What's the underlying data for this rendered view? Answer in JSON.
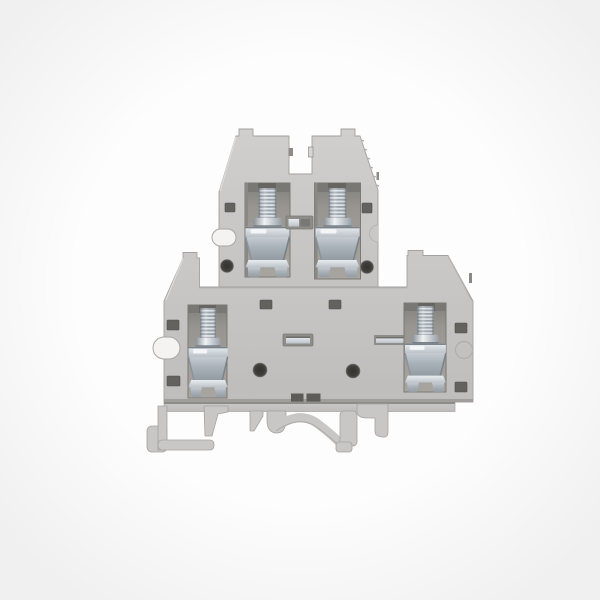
{
  "meta": {
    "description": "Product photograph of a gray double-level DIN-rail screw terminal block centered on a plain white background",
    "background_color": "#fdfdfd"
  },
  "product": {
    "name": "double-level-din-rail-terminal-block",
    "levels": 2,
    "screw_terminal_count": 4,
    "visible_parts": [
      "upper-wire-entry-towers",
      "upper-left-screw-clamp",
      "upper-right-screw-clamp",
      "lower-left-screw-clamp",
      "lower-right-screw-clamp",
      "jumper-test-slots",
      "cross-connect-metal-bar",
      "mounting-holes",
      "din-rail-foot"
    ],
    "palette": {
      "bg": "#fdfdfd",
      "housing": "#c6c4c2",
      "housing-light": "#d2d0ce",
      "housing-dark": "#a5a3a1",
      "cavity": "#98958f",
      "cavity-dark": "#7e7c78",
      "slot": "#64625f",
      "hole": "#413f3c",
      "metal-light": "#e9edf0",
      "metal-mid": "#aeb6be",
      "metal-dark": "#8d959d",
      "foot": "#c9c7c5"
    }
  }
}
